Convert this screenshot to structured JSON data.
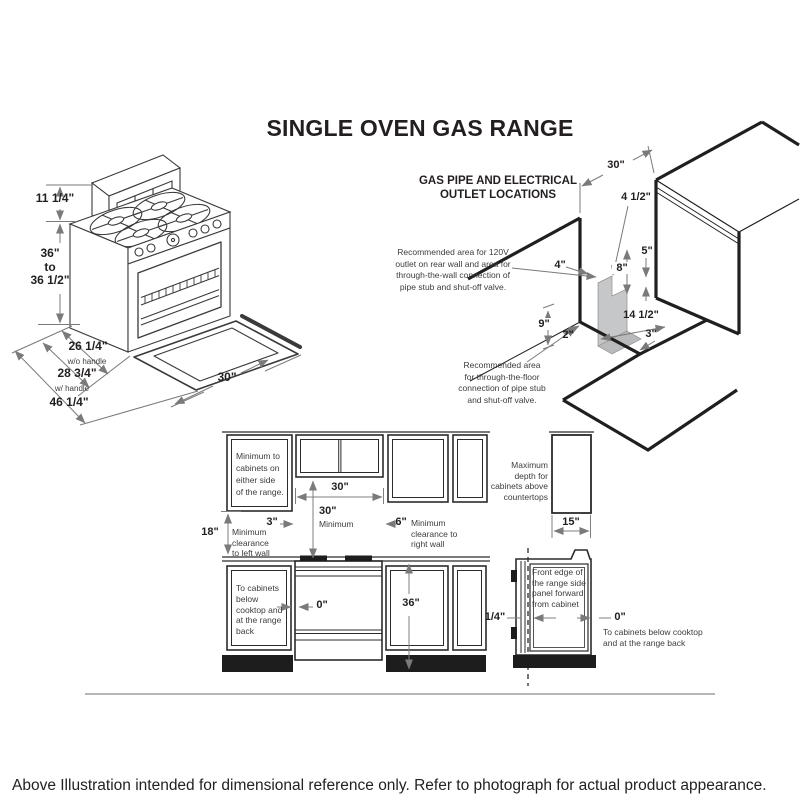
{
  "title": "SINGLE OVEN GAS RANGE",
  "range_isometric": {
    "dims": {
      "backsplash_height": "11 1/4\"",
      "body_height": "36\"\nto\n36 1/2\"",
      "depth_without_handle": "26 1/4\"",
      "depth_without_handle_note": "w/o handle",
      "depth_with_handle": "28 3/4\"",
      "depth_with_handle_note": "w/ handle",
      "depth_door_open": "46 1/4\"",
      "width": "30\""
    }
  },
  "gas_pipe_diagram": {
    "heading": "GAS PIPE AND ELECTRICAL\nOUTLET LOCATIONS",
    "note_wall": "Recommended area for 120V\noutlet on rear wall and area for\nthrough-the-wall connection of\npipe stub and shut-off valve.",
    "note_floor": "Recommended area\nfor through-the-floor\nconnection of pipe stub\nand shut-off valve.",
    "dims": {
      "opening_width": "30\"",
      "outlet_offset_top": "4 1/2\"",
      "outlet_offset_left": "4\"",
      "gap_right": "5\"",
      "outlet_zone_height": "8\"",
      "wall_zone_height": "9\"",
      "floor_strip_depth": "2\"",
      "floor_zone_width": "14 1/2\"",
      "floor_strip_right": "3\""
    }
  },
  "front_elevation": {
    "note_side_cabinets": "Minimum to\ncabinets on\neither side\nof the range.",
    "opening_width": "30\"",
    "left_gap": "3\"",
    "vertical_min": "30\"",
    "vertical_min_word": "Minimum",
    "right_gap": "6\"",
    "note_right_wall": "Minimum\nclearance to\nright wall",
    "left_wall_height": "18\"",
    "note_left_wall": "Minimum\nclearance\nto left wall",
    "note_below_cabinets": "To cabinets\nbelow\ncooktop and\nat the range\nback",
    "zero_gap": "0\"",
    "counter_height": "36\""
  },
  "side_elevation": {
    "note_max_depth": "Maximum\ndepth for\ncabinets above\ncountertops",
    "cabinet_depth": "15\"",
    "note_front_edge": "Front edge of\nthe range side\npanel forward\nfrom cabinet",
    "front_offset": "1/4\"",
    "zero_gap": "0\"",
    "note_below_cabinets": "To cabinets below cooktop\nand at the range back"
  },
  "footer": {
    "disclaimer": "Above Illustration intended for dimensional reference only. Refer to photograph for actual product appearance."
  }
}
